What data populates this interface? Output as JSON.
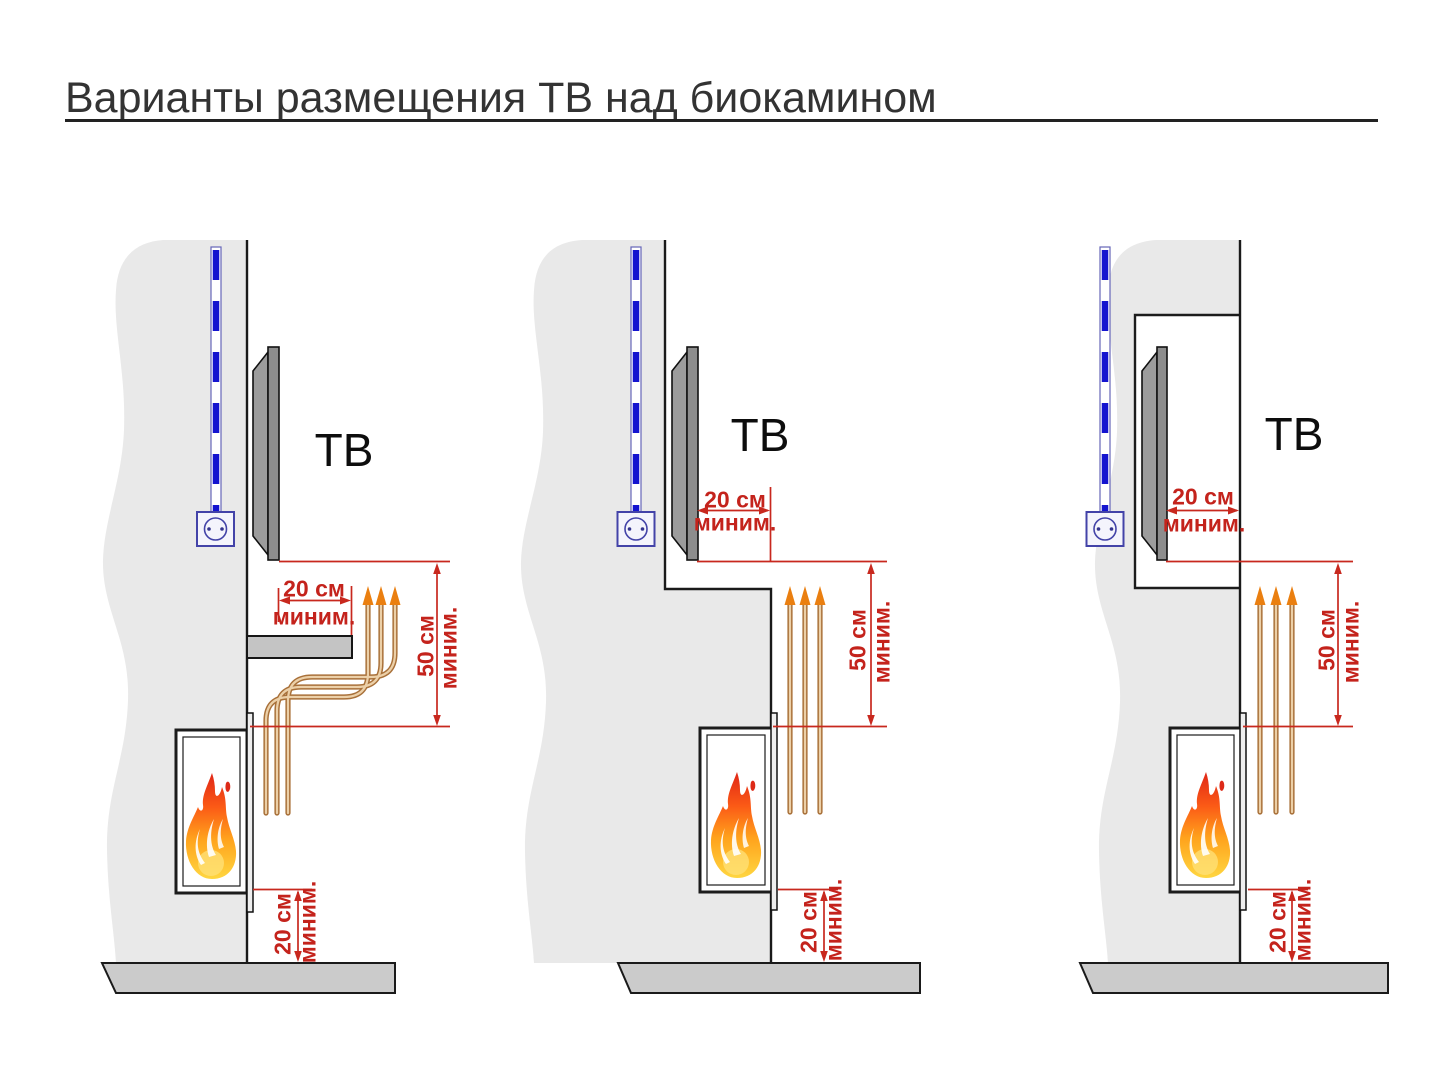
{
  "title": "Варианты размещения ТВ над биокамином",
  "labels": {
    "tv": "ТВ",
    "minimum": "миним."
  },
  "diagrams": [
    {
      "name": "variant-1-protective-shelf",
      "tv_label": "ТВ",
      "tv_to_shelf_edge": {
        "value": "20 см",
        "qualifier": "миним."
      },
      "tv_to_fireplace": {
        "value": "50 см",
        "qualifier": "миним."
      },
      "fireplace_to_floor": {
        "value": "20 см",
        "qualifier": "миним."
      }
    },
    {
      "name": "variant-2-recessed-tv-wall-step",
      "tv_label": "ТВ",
      "tv_to_wall_face": {
        "value": "20 см",
        "qualifier": "миним."
      },
      "tv_to_fireplace": {
        "value": "50 см",
        "qualifier": "миним."
      },
      "fireplace_to_floor": {
        "value": "20 см",
        "qualifier": "миним."
      }
    },
    {
      "name": "variant-3-tv-in-niche",
      "tv_label": "ТВ",
      "tv_to_wall_face": {
        "value": "20 см",
        "qualifier": "миним."
      },
      "tv_to_fireplace": {
        "value": "50 см",
        "qualifier": "миним."
      },
      "fireplace_to_floor": {
        "value": "20 см",
        "qualifier": "миним."
      }
    }
  ],
  "colors": {
    "dimension_red": "#c4231c",
    "cable_blue": "#1414cf",
    "socket_blue": "#4343a8",
    "heat_arrow_orange": "#ea7f10",
    "heat_tube_brown": "#a9713a",
    "wall_gray": "#e9e9e9",
    "floor_gray": "#cbcbcb",
    "tv_gray": "#8d8d8d"
  }
}
